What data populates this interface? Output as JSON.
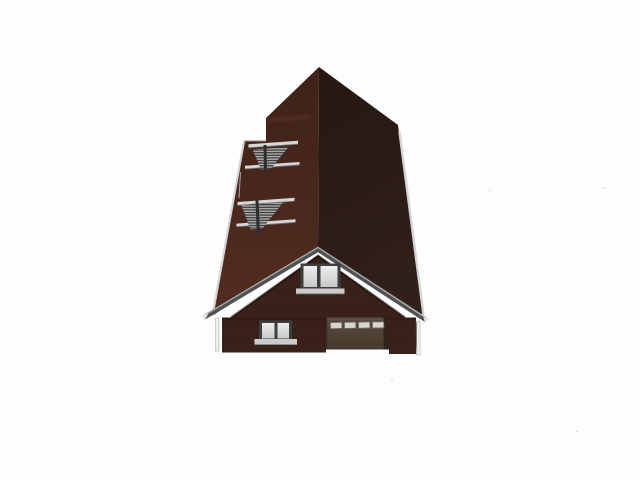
{
  "scene": {
    "description": "3D architectural render of a dark brown brick house viewed from the front and above: tall steep gable roof with two louvered skylight vents on the left slope, front cross-gable with attic window, ground floor with a double window and a garage door",
    "width": 640,
    "height": 480,
    "background": "#fdfdfd"
  },
  "colors": {
    "background": "#fdfdfd",
    "roof_left_top": "#3f2219",
    "roof_left_bottom": "#532d21",
    "roof_right_top": "#271711",
    "roof_right_bottom": "#31201a",
    "roof_step_face": "#5a3426",
    "brick_wall": "#3b221a",
    "fascia": "#4f5152",
    "fascia_highlight": "#a8aaac",
    "gutter": "#d4d5d6",
    "trim_bar": "#d8d8d8",
    "slat_light": "#ababab",
    "slat_dark": "#3d3d3d",
    "louver_divider": "#2e2e2e",
    "window_frame": "#3e3e3e",
    "pane_top": "#eceeef",
    "pane_bottom": "#c6c8ca",
    "sill": "#cbcbcb",
    "garage_top": "#584a3c",
    "garage_bottom": "#463a2d",
    "garage_jamb": "#2f241b",
    "garage_window": "#d8d5ce",
    "downspout": "#ededee",
    "under_eave_shadow": "#2c1a12",
    "soffit_tip": "#e8e8e8",
    "artifact_dot": "#c4c4c4"
  },
  "house": {
    "parts": [
      "main-roof-left-plane",
      "main-roof-right-plane",
      "upper-roof-louver-vent",
      "lower-roof-louver-vent",
      "front-gable",
      "attic-window",
      "ground-floor-window",
      "garage-door",
      "left-downspout",
      "right-downspout"
    ]
  }
}
